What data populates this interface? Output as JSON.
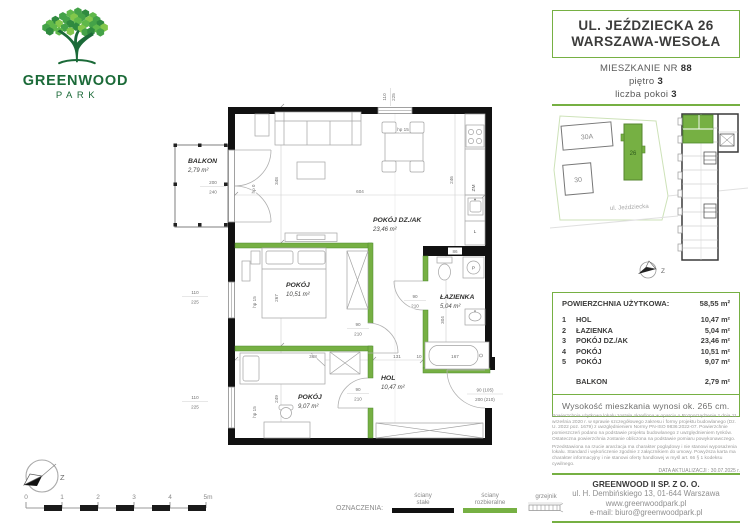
{
  "logo": {
    "name": "GREENWOOD",
    "sub": "PARK"
  },
  "header": {
    "address_line1": "UL. JEŹDZIECKA 26",
    "address_line2": "WARSZAWA-WESOŁA",
    "unit_label": "MIESZKANIE NR ",
    "unit_number": "88",
    "floor_label": "piętro ",
    "floor_value": "3",
    "rooms_label": "liczba pokoi ",
    "rooms_value": "3"
  },
  "site": {
    "b30a": "30A",
    "b30": "30",
    "b26": "26",
    "street": "ul. Jeździecka",
    "compass": "Z"
  },
  "plan": {
    "compass": "Z",
    "rooms": {
      "living": {
        "name": "POKÓJ DZ./AK",
        "area": "23,46 m²"
      },
      "bedroom": {
        "name": "POKÓJ",
        "area": "10,51 m²"
      },
      "bath": {
        "name": "ŁAZIENKA",
        "area": "5,04 m²"
      },
      "hall": {
        "name": "HOL",
        "area": "10,47 m²"
      },
      "bedroom2": {
        "name": "POKÓJ",
        "area": "9,07 m²"
      },
      "balcony": {
        "name": "BALKON",
        "area": "2,79 m²"
      }
    },
    "dims": {
      "d604": "604",
      "d348": "348",
      "d246": "246",
      "d267": "267",
      "d249": "249",
      "d368": "368",
      "d131": "131",
      "d10": "10",
      "d167": "167",
      "d86": "86",
      "d304": "304",
      "win_w": "110",
      "win_h": "225",
      "door_w": "90",
      "door_h": "210",
      "ent_w": "90 (105)",
      "ent_h": "200 (210)",
      "balc_w": "200",
      "balc_h": "240",
      "hp15": "hp 15",
      "hp0": "hp 0"
    },
    "appliances": {
      "dishwasher": "ZM",
      "fridge": "L",
      "washer": "P"
    }
  },
  "scalebar": {
    "ticks": [
      "0",
      "1",
      "2",
      "3",
      "4",
      "5m"
    ]
  },
  "legend": {
    "title": "OZNACZENIA:",
    "solid": [
      "ściany",
      "stałe"
    ],
    "removable": [
      "ściany",
      "rozbieralne"
    ],
    "radiator": "grzejnik"
  },
  "area_table": {
    "title": "POWIERZCHNIA UŻYTKOWA:",
    "total": "58,55 m²",
    "rows": [
      {
        "no": "1",
        "name": "HOL",
        "area": "10,47 m²"
      },
      {
        "no": "2",
        "name": "ŁAZIENKA",
        "area": "5,04 m²"
      },
      {
        "no": "3",
        "name": "POKÓJ DZ./AK",
        "area": "23,46 m²"
      },
      {
        "no": "4",
        "name": "POKÓJ",
        "area": "10,51 m²"
      },
      {
        "no": "5",
        "name": "POKÓJ",
        "area": "9,07 m²"
      }
    ],
    "balcony": {
      "name": "BALKON",
      "area": "2,79 m²"
    },
    "height_note": "Wysokość mieszkania wynosi ok. 265 cm."
  },
  "disclaimer": {
    "para1": "Powierzchnia użytkowa lokalu została określona w oparciu o Rozporządzenie z dnia 11 września 2020 r. w sprawie szczegółowego zakresu i formy projektu budowlanego (Dz. U. 2022 poz. 1679) z uwzględnieniem Normy PN-ISO 9836:2022-07. Powierzchnie pomieszczeń podano na podstawie projektu budowlanego z uwzględnieniem tynków. Ostateczna powierzchnia zostanie obliczona na podstawie pomiaru powykonawczego.",
    "para2": "Przedstawiona na rzucie aranżacja ma charakter poglądowy i nie stanowi wyposażenia lokalu. Standard i wykończenie zgodnie z załącznikiem do umowy. Powyższa karta ma charakter informacyjny i nie stanowi oferty handlowej w myśl art. 66 § 1 kodeksu cywilnego.",
    "date": "DATA AKTUALIZACJI : 30.07.2025 r."
  },
  "footer": {
    "company": "GREENWOOD II SP. Z O. O.",
    "address": "ul. H. Dembińskiego 13, 01-644 Warszawa",
    "web": "www.greenwoodpark.pl",
    "email": "e-mail: biuro@greenwoodpark.pl"
  },
  "colors": {
    "green": "#76B043",
    "dark_green": "#1B6A38",
    "wall": "#111111"
  }
}
